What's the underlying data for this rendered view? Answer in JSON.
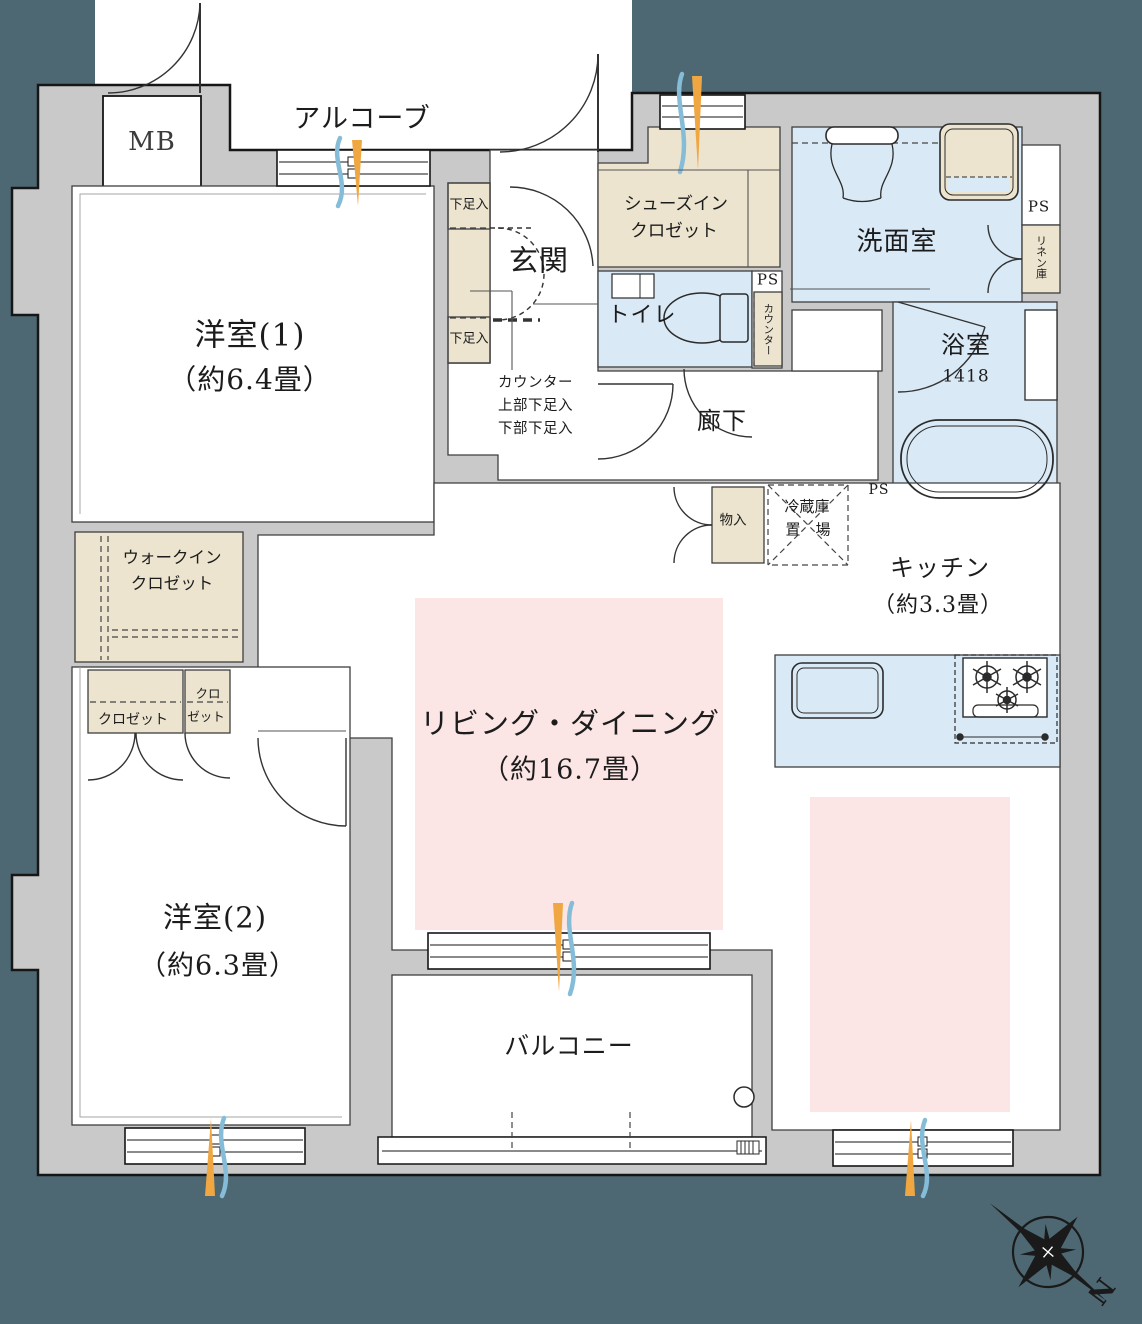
{
  "plan": {
    "colors": {
      "exterior_background": "#4d6873",
      "wall_fill": "#c9c9c9",
      "closet_fill": "#ece4cf",
      "wet_area_fill": "#d9e9f6",
      "living_accent": "#fbe6e5",
      "airflow_warm": "#f0a742",
      "airflow_cool": "#85bdd9"
    },
    "labels": {
      "mb": "MB",
      "alcove": "アルコーブ",
      "bedroom1_name": "洋室(1)",
      "bedroom1_size": "（約6.4畳）",
      "shoe_box": "下足入",
      "entrance": "玄関",
      "counter_note_1": "カウンター",
      "counter_note_2": "上部下足入",
      "counter_note_3": "下部下足入",
      "shoes_closet_1": "シューズイン",
      "shoes_closet_2": "クロゼット",
      "toilet": "トイレ",
      "ps": "PS",
      "counter_vertical": "カウンター",
      "washroom": "洗面室",
      "linen": "リネン庫",
      "bath_name": "浴室",
      "bath_size": "1418",
      "corridor": "廊下",
      "storage": "物入",
      "fridge_1": "冷蔵庫",
      "fridge_2": "置　場",
      "kitchen_name": "キッチン",
      "kitchen_size": "（約3.3畳）",
      "living_name": "リビング・ダイニング",
      "living_size": "（約16.7畳）",
      "wic_1": "ウォークイン",
      "wic_2": "クロゼット",
      "closet": "クロゼット",
      "closet_small_1": "クロ",
      "closet_small_2": "ゼット",
      "bedroom2_name": "洋室(2)",
      "bedroom2_size": "（約6.3畳）",
      "balcony": "バルコニー",
      "compass_north": "N"
    }
  }
}
